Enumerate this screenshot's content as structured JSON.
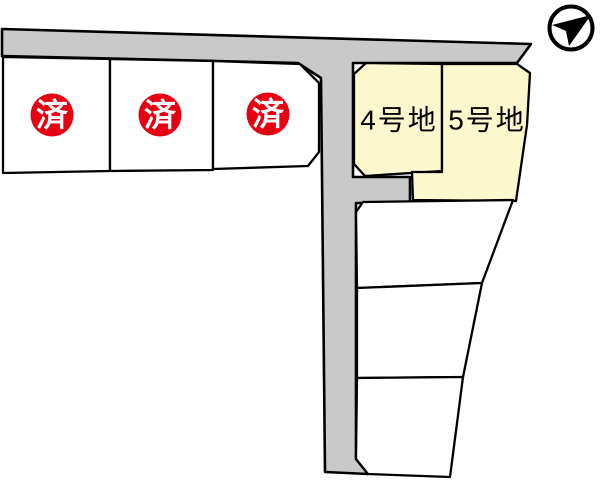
{
  "canvas": {
    "width": 600,
    "height": 481,
    "background": "#ffffff"
  },
  "colors": {
    "road_fill": "#c9c9c9",
    "lot_sold_fill": "#ffffff",
    "lot_available_fill": "#fbf8cd",
    "lot_vacant_fill": "#ffffff",
    "sold_badge_fill": "#e60012",
    "sold_badge_text": "#ffffff",
    "label_text": "#000000",
    "outline": "#000000",
    "compass_fill": "#000000"
  },
  "compass": {
    "icon": "north-arrow-icon",
    "cx": 571,
    "cy": 28,
    "r": 21.5,
    "arrow_points": "591,15 552,25 566,31 569,46"
  },
  "road": {
    "points": "2,29 531,44 517,63 353,63 353,177 410,177 410,203 356,203 356,459 368,474 325,472 321,78 298,63 2,56"
  },
  "lots": {
    "sold": [
      {
        "name": "lot-sold-1",
        "points": "3,57 110,59 110,171 3,173",
        "label": "済",
        "badge": {
          "cx": 52,
          "cy": 115,
          "r": 21.5
        }
      },
      {
        "name": "lot-sold-2",
        "points": "110,59 213,61 213,170 110,171",
        "label": "済",
        "badge": {
          "cx": 160,
          "cy": 115,
          "r": 21.5
        }
      },
      {
        "name": "lot-sold-3",
        "points": "213,61 300,64 319,83 319,152 308,166 213,169",
        "label": "済",
        "badge": {
          "cx": 268,
          "cy": 114,
          "r": 21.5
        }
      }
    ],
    "available": [
      {
        "name": "lot-4",
        "label": "4号地",
        "label_x": 399,
        "label_y": 120,
        "points": "366,63 442,64 442,171 365,176 354,164 354,74"
      },
      {
        "name": "lot-5",
        "label": "5号地",
        "label_x": 487,
        "label_y": 120,
        "points": "442,64 517,64 530,73 527,125 516,201 413,200 412,172 442,172"
      }
    ],
    "vacant": [
      {
        "name": "lot-vacant-1",
        "points": "363,202 513,200 482,283 357,288 356,212"
      },
      {
        "name": "lot-vacant-2",
        "points": "357,288 482,283 463,377 357,378"
      },
      {
        "name": "lot-vacant-3",
        "points": "357,378 463,377 450,477 368,474 356,459"
      }
    ]
  }
}
